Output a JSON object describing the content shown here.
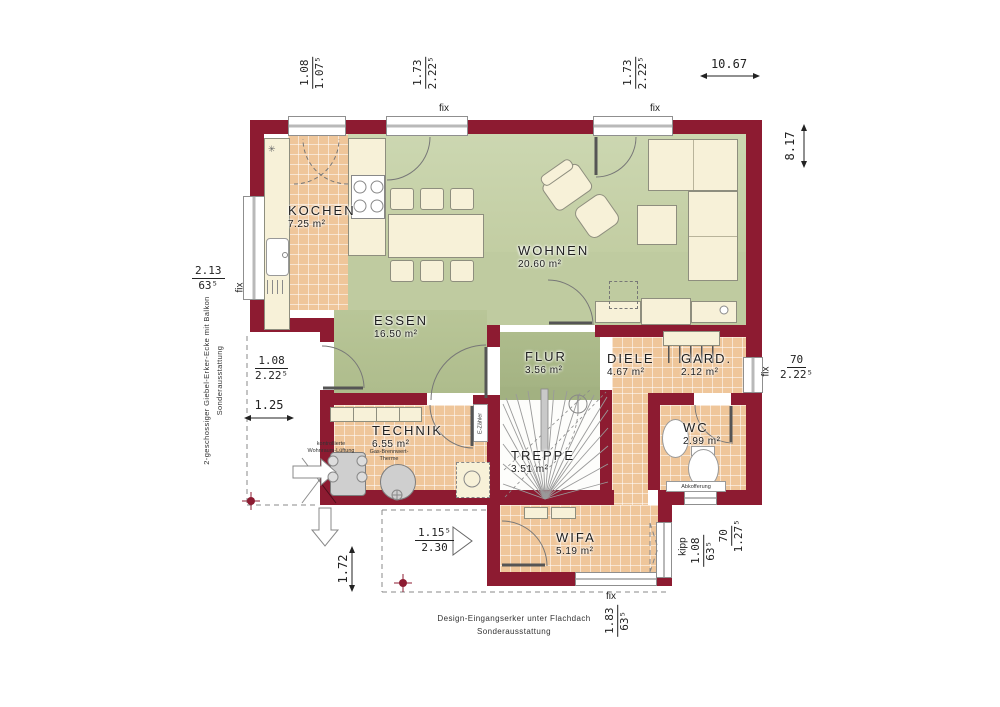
{
  "rooms": {
    "kochen": {
      "name": "KOCHEN",
      "area": "7.25 m²"
    },
    "essen": {
      "name": "ESSEN",
      "area": "16.50 m²"
    },
    "wohnen": {
      "name": "WOHNEN",
      "area": "20.60 m²"
    },
    "flur": {
      "name": "FLUR",
      "area": "3.56 m²"
    },
    "diele": {
      "name": "DIELE",
      "area": "4.67 m²"
    },
    "gard": {
      "name": "GARD.",
      "area": "2.12 m²"
    },
    "technik": {
      "name": "TECHNIK",
      "area": "6.55 m²"
    },
    "treppe": {
      "name": "TREPPE",
      "area": "3.51 m²"
    },
    "wc": {
      "name": "WC",
      "area": "2.99 m²"
    },
    "wifa": {
      "name": "WIFA",
      "area": "5.19 m²"
    }
  },
  "dims": {
    "top_kitchen": {
      "num": "1.08",
      "den": "1.07⁵"
    },
    "top_left_fix": {
      "num": "1.73",
      "den": "2.22⁵"
    },
    "top_right_fix": {
      "num": "1.73",
      "den": "2.22⁵"
    },
    "total_width": "10.67",
    "total_height": "8.17",
    "left_window": {
      "num": "2.13",
      "den": "63⁵"
    },
    "terrace_door": {
      "num": "1.08",
      "den": "2.22⁵"
    },
    "left_offset": "1.25",
    "front_offset": "1.72",
    "entry_door": {
      "num": "1.15⁵",
      "den": "2.30"
    },
    "right_window": {
      "num": "70",
      "den": "2.22⁵"
    },
    "wifa_side_window": {
      "num": "1.08",
      "den": "63⁵"
    },
    "wifa_corner": {
      "num": "70",
      "den": "1.27⁵"
    },
    "wifa_front_window": {
      "num": "1.83",
      "den": "63⁵"
    }
  },
  "glazing": {
    "fix": "fix",
    "kipp": "kipp"
  },
  "notes": {
    "side": [
      "2-geschossiger Giebel-Erker-Ecke mit Balkon",
      "Sonderausstattung"
    ],
    "bottom": [
      "Design-Eingangserker unter Flachdach",
      "Sonderausstattung"
    ]
  },
  "equipment": {
    "ventilation": "kontrollierte Wohnraum-Lüftung",
    "boiler": "Gas-Brennwert-Therme",
    "meter": "E-Zähler",
    "duct": "Abkofferung"
  },
  "colors": {
    "wall": "#8d1b31",
    "living": "#c7d1a8",
    "dining": "#b9c698",
    "hall": "#aebc8c",
    "tile": "#efc69a"
  }
}
